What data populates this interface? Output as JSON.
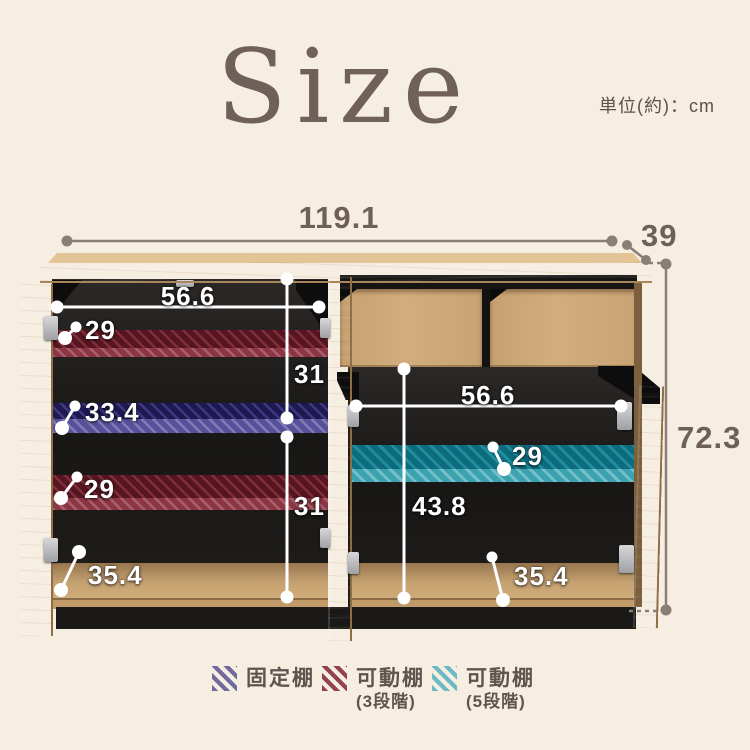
{
  "title": "Size",
  "unit_label": "単位(約)：cm",
  "dims": {
    "total_width": "119.1",
    "total_depth": "39",
    "total_height": "72.3"
  },
  "left_section": {
    "inner_width": "56.6",
    "upper_shelf_depth": "29",
    "upper_gap": "31",
    "fixed_shelf_depth": "33.4",
    "lower_shelf_depth": "29",
    "lower_gap": "31",
    "bottom_depth": "35.4"
  },
  "right_section": {
    "inner_width": "56.6",
    "shelf_depth": "29",
    "inner_height": "43.8",
    "bottom_depth": "35.4"
  },
  "legend": {
    "items": [
      {
        "label": "固定棚",
        "sub": "",
        "color": "#716a9c"
      },
      {
        "label": "可動棚",
        "sub": "(3段階)",
        "color": "#93414d"
      },
      {
        "label": "可動棚",
        "sub": "(5段階)",
        "color": "#6cb9c5"
      }
    ]
  },
  "colors": {
    "background": "#f7eee2",
    "wood": "#cda878",
    "interior": "#1d1b19",
    "dimension_text": "#6e6056",
    "dimension_line": "#8b7e74",
    "fixed_shelf": "#716a9c",
    "movable_shelf_3steps": "#93414d",
    "movable_shelf_5steps": "#6cb9c5"
  }
}
